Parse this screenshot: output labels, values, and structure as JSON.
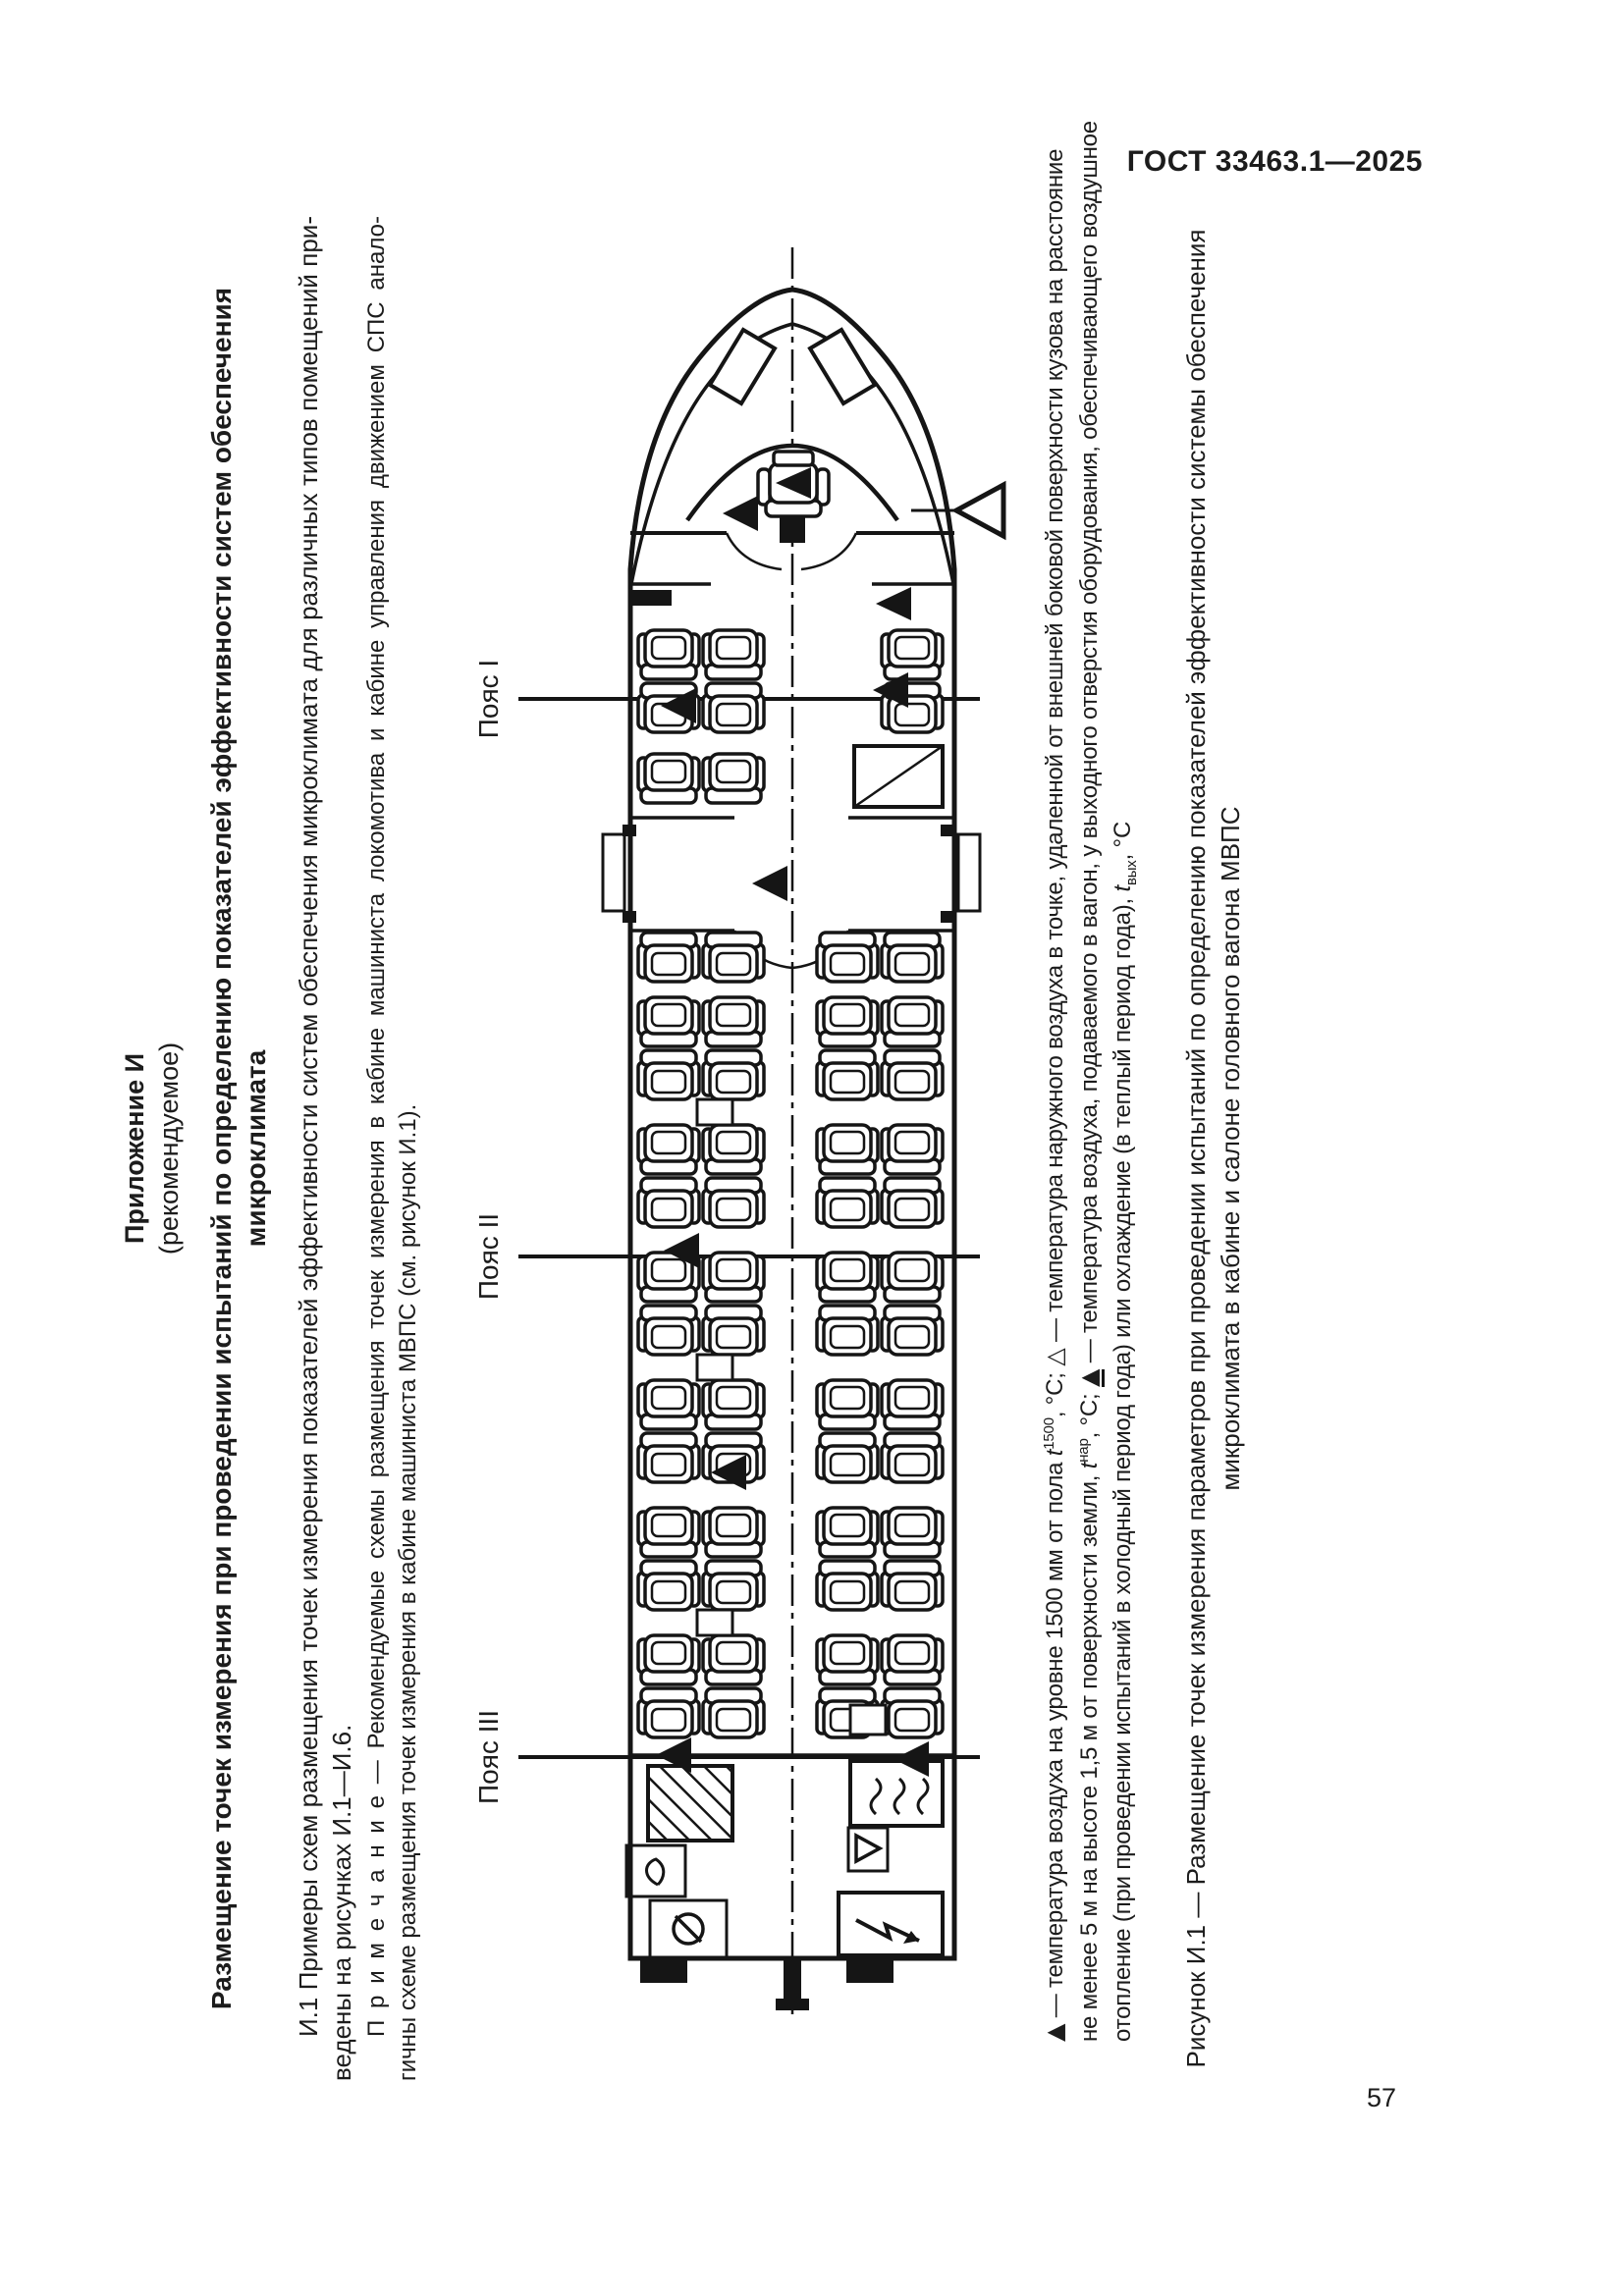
{
  "page": {
    "header": "ГОСТ 33463.1—2025",
    "number": "57"
  },
  "appendix": {
    "label": "Приложение И",
    "sublabel": "(рекомендуемое)",
    "title_line1": "Размещение точек измерения при проведении испытаний по определению показателей эффективности систем обеспечения",
    "title_line2": "микроклимата"
  },
  "body": {
    "para_line1": "И.1 Примеры схем размещения точек измерения показателей эффективности систем обеспечения микроклимата для различных типов помещений при-",
    "para_line2": "ведены на рисунках И.1—И.6.",
    "note_line1": "П р и м е ч а н и е  — Рекомендуемые схемы размещения точек измерения в кабине машиниста локомотива и кабине управления движением СПС анало-",
    "note_line2": "гичны схеме размещения точек измерения в кабине машиниста МВПС (см. рисунок И.1)."
  },
  "figure": {
    "belts": [
      {
        "label": "Пояс I"
      },
      {
        "label": "Пояс II"
      },
      {
        "label": "Пояс III"
      }
    ],
    "legend": {
      "sym_inside": "▲",
      "sym_outside": "△",
      "sym_supply": "▲",
      "l1_a": " — температура воздуха на уровне 1500 мм от пола ",
      "l1_var": "t",
      "l1_sup": "1500",
      "l1_b": ", °C; ",
      "l1_c": " — температура наружного воздуха в точке, удаленной от внешней боковой поверхности кузова на расстояние",
      "l2_a": "не менее 5 м на высоте 1,5 м от поверхности земли, ",
      "l2_var": "t",
      "l2_sup": "нар",
      "l2_b": ", °C; ",
      "l2_c": " — температура воздуха, подаваемого в вагон, у выходного отверстия оборудования, обеспечивающего воздушное",
      "l3_a": "отопление (при проведении испытаний в холодный период года) или охлаждение (в теплый период года), ",
      "l3_var": "t",
      "l3_sub": "вых",
      "l3_b": ", °C"
    },
    "caption_line1": "Рисунок И.1 — Размещение точек измерения параметров при проведении испытаний по определению показателей эффективности системы обеспечения",
    "caption_line2": "микроклимата в кабине и салоне головного вагона МВПС"
  }
}
